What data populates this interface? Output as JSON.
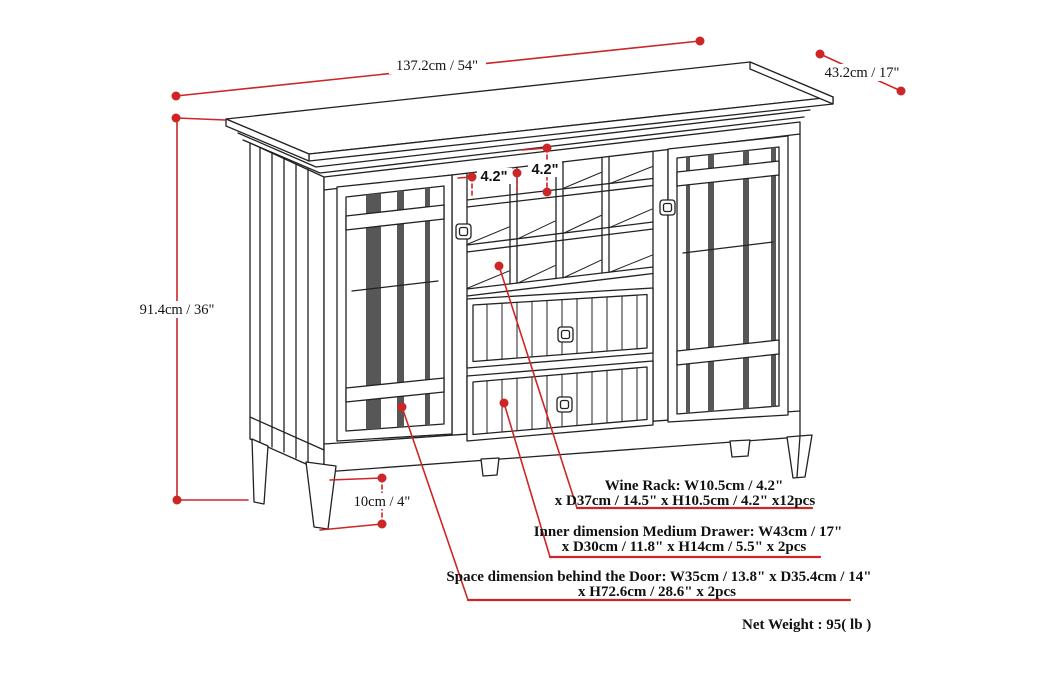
{
  "diagram": {
    "dimensions": {
      "width": "137.2cm / 54\"",
      "depth": "43.2cm / 17\"",
      "height": "91.4cm / 36\"",
      "cubby_width": "4.2\"",
      "cubby_height": "4.2\"",
      "leg_height": "10cm / 4\""
    },
    "annotations": {
      "wine_rack": {
        "line1": "Wine Rack: W10.5cm / 4.2\"",
        "line2": "x D37cm / 14.5\" x H10.5cm / 4.2\" x12pcs"
      },
      "medium_drawer": {
        "line1": "Inner dimension Medium Drawer: W43cm / 17\"",
        "line2": "x D30cm / 11.8\" x H14cm / 5.5\" x 2pcs"
      },
      "door_space": {
        "line1": "Space dimension behind the Door:  W35cm / 13.8\" x D35.4cm / 14\"",
        "line2": "x H72.6cm / 28.6\" x 2pcs"
      }
    },
    "net_weight": "Net Weight : 95( lb )",
    "wine_rack_count": "12",
    "drawer_count": "2",
    "door_count": "2",
    "colors": {
      "dimension_red": "#cc2626",
      "line_black": "#222222",
      "glass_shade": "#575757",
      "background": "#ffffff"
    }
  }
}
